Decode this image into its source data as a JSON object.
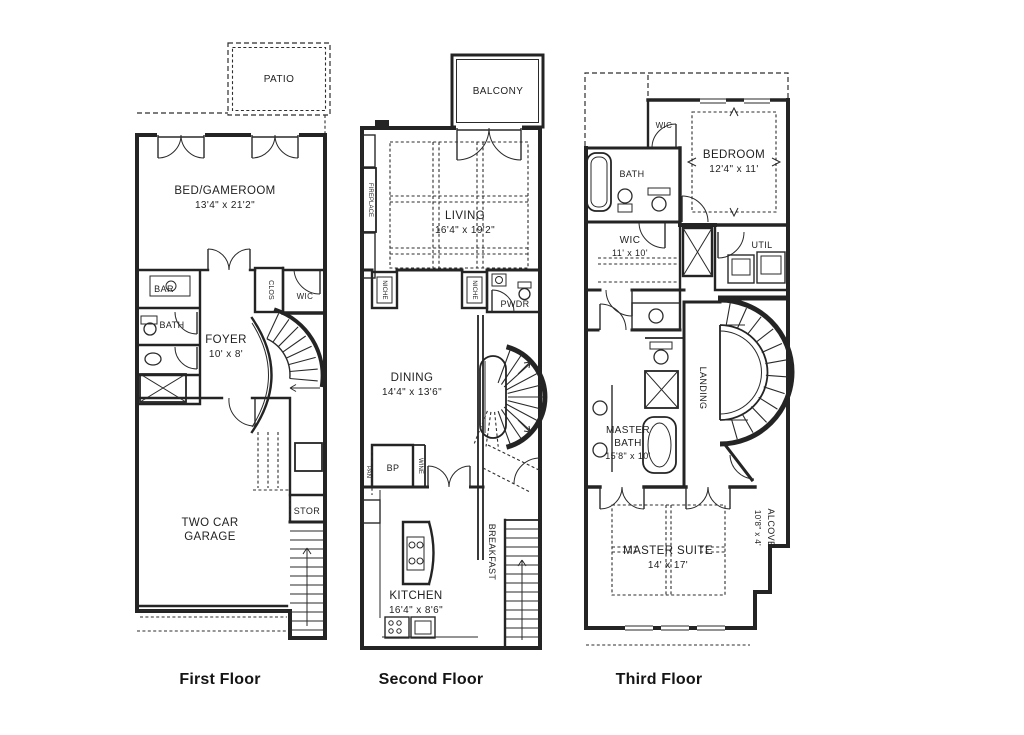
{
  "document": {
    "kind": "residential townhome floor plan, 3 levels",
    "background": "#ffffff",
    "ink": "#242424"
  },
  "floors": [
    {
      "title": "First Floor",
      "rooms": {
        "patio": {
          "label": "PATIO"
        },
        "bed_gameroom": {
          "label": "BED/GAMEROOM",
          "dims": "13'4\" x 21'2\""
        },
        "bar": {
          "label": "BAR"
        },
        "bath": {
          "label": "BATH"
        },
        "foyer": {
          "label": "FOYER",
          "dims": "10' x 8'"
        },
        "clos": {
          "label": "CLOS"
        },
        "wic": {
          "label": "WIC"
        },
        "stor": {
          "label": "STOR"
        },
        "garage": {
          "label_line1": "TWO CAR",
          "label_line2": "GARAGE"
        }
      }
    },
    {
      "title": "Second Floor",
      "rooms": {
        "balcony": {
          "label": "BALCONY"
        },
        "living": {
          "label": "LIVING",
          "dims": "16'4\" x 19'2\""
        },
        "fireplace": {
          "label": "FIREPLACE"
        },
        "niche": {
          "label": "NICHE"
        },
        "pwdr": {
          "label": "PWDR"
        },
        "dining": {
          "label": "DINING",
          "dims": "14'4\" x 13'6\""
        },
        "bp": {
          "label": "BP"
        },
        "pan": {
          "label": "PAN"
        },
        "wine": {
          "label": "WINE"
        },
        "kitchen": {
          "label": "KITCHEN",
          "dims": "16'4\" x 8'6\""
        },
        "breakfast": {
          "label": "BREAKFAST"
        }
      }
    },
    {
      "title": "Third Floor",
      "rooms": {
        "wic_upper": {
          "label": "WIC"
        },
        "bath": {
          "label": "BATH"
        },
        "bedroom": {
          "label": "BEDROOM",
          "dims": "12'4\" x 11'"
        },
        "wic": {
          "label": "WIC",
          "dims": "11' x 10'"
        },
        "util": {
          "label": "UTIL"
        },
        "landing": {
          "label": "LANDING"
        },
        "master_bath": {
          "label_line1": "MASTER",
          "label_line2": "BATH",
          "dims": "15'8\" x 10'"
        },
        "master_suite": {
          "label": "MASTER SUITE",
          "dims": "14' x 17'"
        },
        "alcove": {
          "label": "ALCOVE",
          "dims": "10'8\" x 4'"
        }
      }
    }
  ]
}
